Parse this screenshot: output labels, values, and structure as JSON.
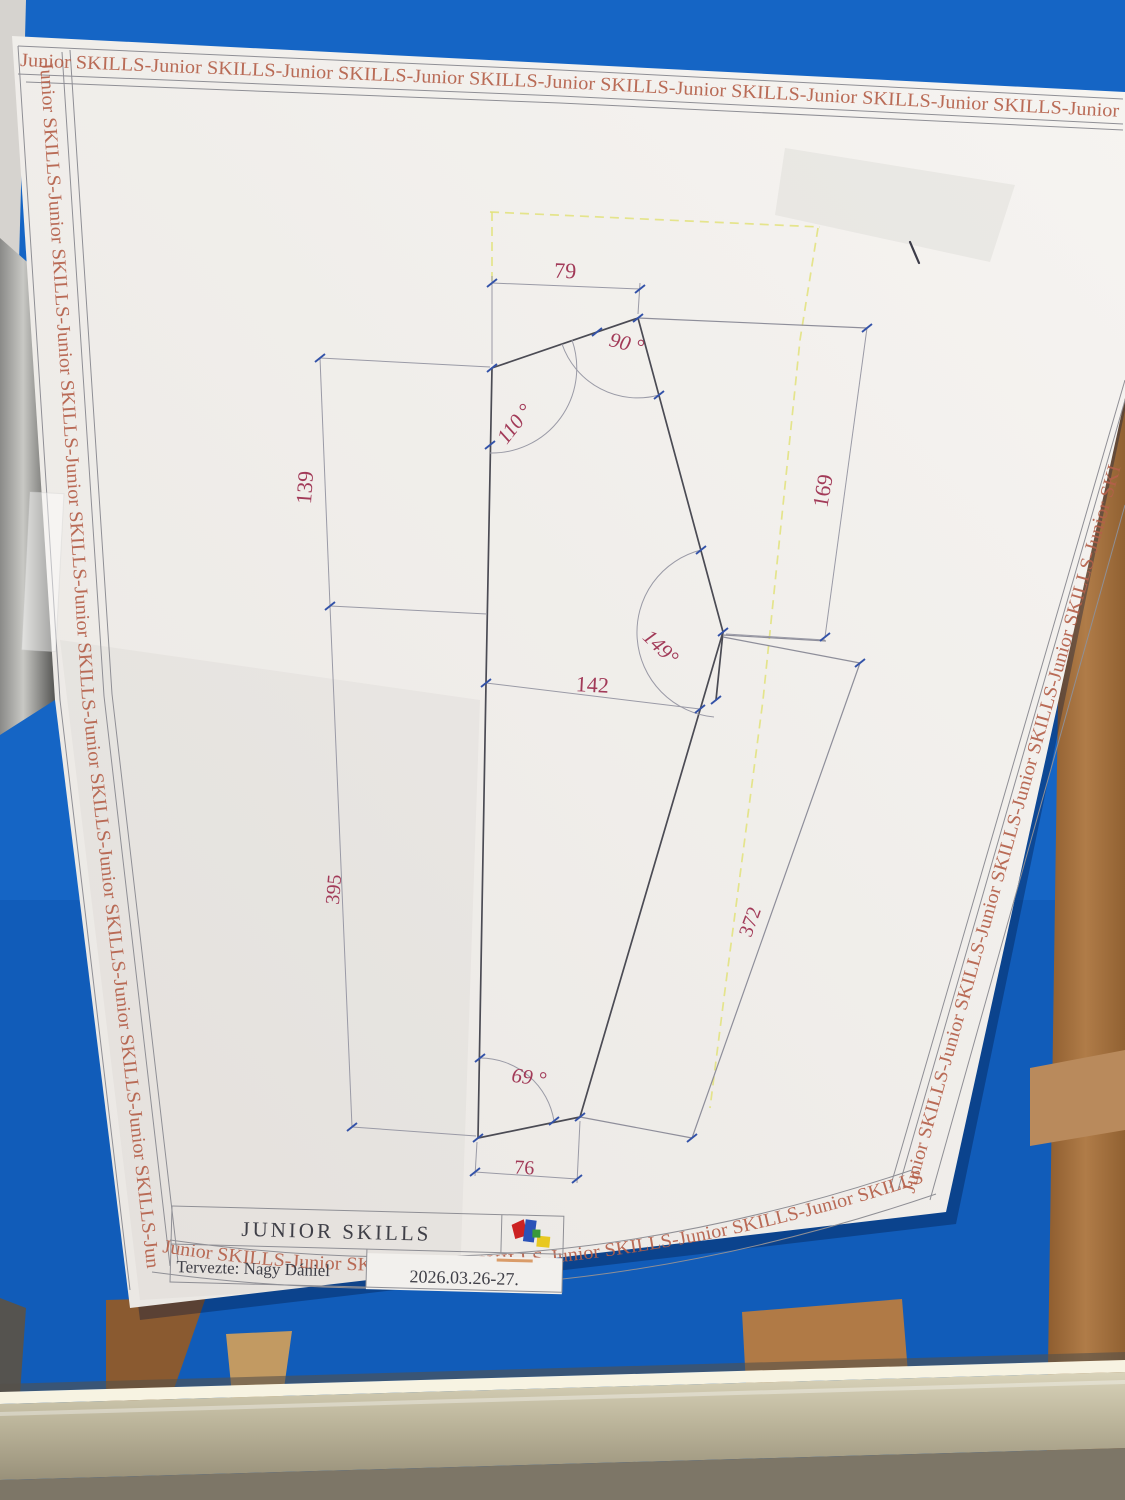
{
  "photo": {
    "border_text": {
      "top": "Junior SKILLS-Junior SKILLS-Junior SKILLS-Junior SKILLS-Junior SKILLS-Junior SKILLS-Junior SKILLS-Junior SKILLS-Junior",
      "left": "Junior SKILLS-Junior SKILLS-Junior SKILLS-Junior SKILLS-Junior SKILLS-Junior SKILLS-Junior SKILLS-Junior SKILLS-Junior SKILLS-Jun",
      "right": "Junior SKILLS-Junior SKILLS-Junior SKILLS-Junior SKILLS-Junior SKILLS-Junior SKI",
      "bottom": "Junior SKILLS-Junior SKILLS-Junior SKILLS-Junior SKILLS-Junior SKILLS-Junior SKILLS-"
    },
    "drawing": {
      "dims": {
        "top_width": "79",
        "left_upper": "139",
        "right_upper": "169",
        "middle_width": "142",
        "left_lower": "395",
        "right_lower": "372",
        "bottom_width": "76"
      },
      "angles": {
        "top": "90 °",
        "upper_left": "110 °",
        "middle_right": "149°",
        "bottom_left": "69 °"
      }
    },
    "title_block": {
      "title": "JUNIOR SKILLS",
      "designer": "Tervezte: Nagy Dániel",
      "date": "2026.03.26-27."
    },
    "colors": {
      "floor_blue": "#1565c5",
      "wood": "#a5713f",
      "metal_rail": "#c9c3ac",
      "paper": "#f2f0ed",
      "border_text": "#b5604a",
      "dim_text": "#a23a58",
      "outline_dark": "#4b4b54",
      "construction_yellow": "#e2e27a",
      "tick_blue": "#3352a8"
    }
  }
}
